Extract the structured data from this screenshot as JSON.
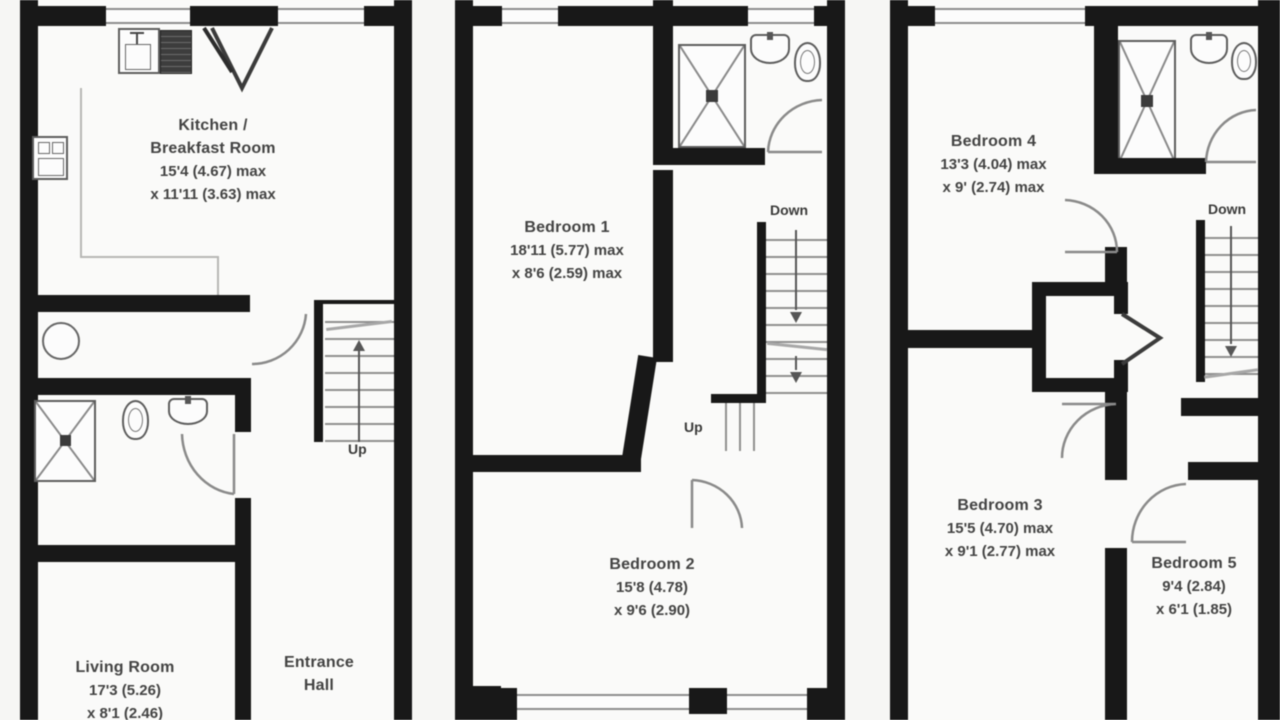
{
  "plan_title": "Three storey house floor plan",
  "colors": {
    "wall": "#161616",
    "text": "#424242",
    "lines": "#8f8f8f"
  },
  "floors": {
    "ground": {
      "kitchen": {
        "name1": "Kitchen /",
        "name2": "Breakfast Room",
        "dim1": "15'4 (4.67) max",
        "dim2": "x 11'11 (3.63) max"
      },
      "living": {
        "name": "Living Room",
        "dim1": "17'3 (5.26)",
        "dim2": "x 8'1 (2.46)"
      },
      "hall": {
        "name1": "Entrance",
        "name2": "Hall"
      },
      "stairs": {
        "up": "Up"
      }
    },
    "first": {
      "bedroom1": {
        "name": "Bedroom 1",
        "dim1": "18'11 (5.77) max",
        "dim2": "x 8'6 (2.59) max"
      },
      "bedroom2": {
        "name": "Bedroom 2",
        "dim1": "15'8 (4.78)",
        "dim2": "x 9'6 (2.90)"
      },
      "stairs": {
        "down": "Down",
        "up": "Up"
      }
    },
    "second": {
      "bedroom4": {
        "name": "Bedroom 4",
        "dim1": "13'3 (4.04) max",
        "dim2": "x 9' (2.74) max"
      },
      "bedroom3": {
        "name": "Bedroom 3",
        "dim1": "15'5 (4.70) max",
        "dim2": "x 9'1 (2.77) max"
      },
      "bedroom5": {
        "name": "Bedroom 5",
        "dim1": "9'4 (2.84)",
        "dim2": "x 6'1 (1.85)"
      },
      "stairs": {
        "down": "Down"
      }
    }
  }
}
